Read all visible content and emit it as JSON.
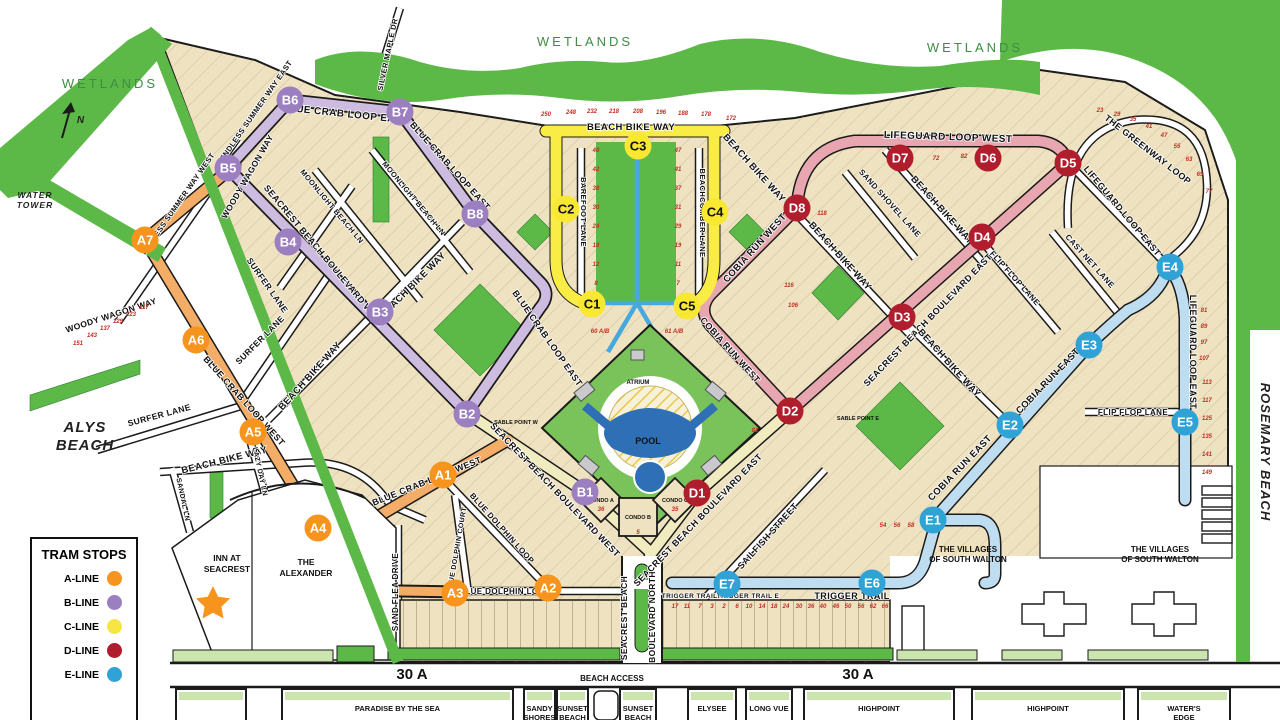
{
  "title": "Seacrest Beach community tram map",
  "colors": {
    "tan": "#efe2c0",
    "outline": "#1b1b1b",
    "green": "#5cb947",
    "light_green": "#cce5af",
    "a_stop": "#f7941d",
    "a_road": "#f4ad67",
    "b_stop": "#9c7fc0",
    "b_road": "#cdbce0",
    "c_stop": "#f9e832",
    "c_road": "#f8ec45",
    "d_stop": "#b01e2e",
    "d_road": "#e8a7b0",
    "e_stop": "#2fa3d6",
    "e_road": "#bfddf0",
    "pale_blvd": "#f1ecc0",
    "lot_number": "#c03026",
    "pool_blue": "#2f6fb5",
    "path_blue": "#46a8dc"
  },
  "legend": {
    "title": "TRAM STOPS",
    "items": [
      {
        "label": "A-LINE",
        "color": "#f7941d"
      },
      {
        "label": "B-LINE",
        "color": "#9c7fc0"
      },
      {
        "label": "C-LINE",
        "color": "#f5e642"
      },
      {
        "label": "D-LINE",
        "color": "#b01e2e"
      },
      {
        "label": "E-LINE",
        "color": "#2fa3d6"
      }
    ]
  },
  "compass": {
    "label": "N"
  },
  "stops": [
    {
      "id": "A1",
      "line": "A",
      "x": 443,
      "y": 475
    },
    {
      "id": "A2",
      "line": "A",
      "x": 548,
      "y": 588
    },
    {
      "id": "A3",
      "line": "A",
      "x": 455,
      "y": 593
    },
    {
      "id": "A4",
      "line": "A",
      "x": 318,
      "y": 528
    },
    {
      "id": "A5",
      "line": "A",
      "x": 253,
      "y": 432
    },
    {
      "id": "A6",
      "line": "A",
      "x": 196,
      "y": 340
    },
    {
      "id": "A7",
      "line": "A",
      "x": 145,
      "y": 240
    },
    {
      "id": "B1",
      "line": "B",
      "x": 585,
      "y": 492
    },
    {
      "id": "B2",
      "line": "B",
      "x": 467,
      "y": 414
    },
    {
      "id": "B3",
      "line": "B",
      "x": 380,
      "y": 312
    },
    {
      "id": "B4",
      "line": "B",
      "x": 288,
      "y": 242
    },
    {
      "id": "B5",
      "line": "B",
      "x": 228,
      "y": 168
    },
    {
      "id": "B6",
      "line": "B",
      "x": 290,
      "y": 100
    },
    {
      "id": "B7",
      "line": "B",
      "x": 400,
      "y": 112
    },
    {
      "id": "B8",
      "line": "B",
      "x": 475,
      "y": 214
    },
    {
      "id": "C1",
      "line": "C",
      "x": 592,
      "y": 304
    },
    {
      "id": "C2",
      "line": "C",
      "x": 566,
      "y": 209
    },
    {
      "id": "C3",
      "line": "C",
      "x": 638,
      "y": 146
    },
    {
      "id": "C4",
      "line": "C",
      "x": 715,
      "y": 212
    },
    {
      "id": "C5",
      "line": "C",
      "x": 687,
      "y": 306
    },
    {
      "id": "D1",
      "line": "D",
      "x": 697,
      "y": 493
    },
    {
      "id": "D2",
      "line": "D",
      "x": 790,
      "y": 411
    },
    {
      "id": "D3",
      "line": "D",
      "x": 902,
      "y": 317
    },
    {
      "id": "D4",
      "line": "D",
      "x": 982,
      "y": 237
    },
    {
      "id": "D5",
      "line": "D",
      "x": 1068,
      "y": 163
    },
    {
      "id": "D6",
      "line": "D",
      "x": 988,
      "y": 158
    },
    {
      "id": "D7",
      "line": "D",
      "x": 900,
      "y": 158
    },
    {
      "id": "D8",
      "line": "D",
      "x": 797,
      "y": 208
    },
    {
      "id": "E1",
      "line": "E",
      "x": 933,
      "y": 520
    },
    {
      "id": "E2",
      "line": "E",
      "x": 1010,
      "y": 425
    },
    {
      "id": "E3",
      "line": "E",
      "x": 1089,
      "y": 345
    },
    {
      "id": "E4",
      "line": "E",
      "x": 1170,
      "y": 267
    },
    {
      "id": "E5",
      "line": "E",
      "x": 1185,
      "y": 422
    },
    {
      "id": "E6",
      "line": "E",
      "x": 872,
      "y": 583
    },
    {
      "id": "E7",
      "line": "E",
      "x": 727,
      "y": 584
    }
  ],
  "streets": [
    {
      "t": "BLUE CRAB LOOP EAST",
      "x": 345,
      "y": 117,
      "r": 6,
      "s": 10
    },
    {
      "t": "BLUE CRAB LOOP EAST",
      "x": 448,
      "y": 168,
      "r": 48,
      "s": 9
    },
    {
      "t": "BLUE CRAB LOOP EAST",
      "x": 545,
      "y": 340,
      "r": 55,
      "s": 9
    },
    {
      "t": "BLUE CRAB LOOP WEST",
      "x": 242,
      "y": 403,
      "r": 48,
      "s": 9
    },
    {
      "t": "BLUE CRAB LOOP WEST",
      "x": 428,
      "y": 484,
      "r": -22,
      "s": 9
    },
    {
      "t": "SEACREST BEACH BOULEVARD WEST",
      "x": 322,
      "y": 258,
      "r": 50,
      "s": 9
    },
    {
      "t": "SEACREST BEACH BOULEVARD WEST",
      "x": 553,
      "y": 492,
      "r": 46,
      "s": 9
    },
    {
      "t": "SEACREST BEACH BOULEVARD EAST",
      "x": 930,
      "y": 322,
      "r": -46,
      "s": 9
    },
    {
      "t": "SEACREST BEACH BOULEVARD EAST",
      "x": 700,
      "y": 522,
      "r": -46,
      "s": 9
    },
    {
      "t": "BEACH BIKE WAY",
      "x": 225,
      "y": 463,
      "r": -14,
      "s": 9.5
    },
    {
      "t": "BEACH BIKE WAY",
      "x": 312,
      "y": 378,
      "r": -48,
      "s": 9.5
    },
    {
      "t": "BEACH BIKE WAY",
      "x": 415,
      "y": 287,
      "r": -45,
      "s": 9.5
    },
    {
      "t": "BEACH BIKE WAY",
      "x": 631,
      "y": 130,
      "r": 0,
      "s": 9.5
    },
    {
      "t": "BEACH BIKE WAY",
      "x": 752,
      "y": 170,
      "r": 48,
      "s": 9.5
    },
    {
      "t": "BEACH BIKE WAY",
      "x": 838,
      "y": 258,
      "r": 48,
      "s": 9.5
    },
    {
      "t": "BEACH BIKE WAY",
      "x": 940,
      "y": 212,
      "r": 48,
      "s": 9.5
    },
    {
      "t": "BEACH BIKE WAY",
      "x": 947,
      "y": 365,
      "r": 48,
      "s": 9.5
    },
    {
      "t": "LIFEGUARD LOOP WEST",
      "x": 948,
      "y": 140,
      "r": 2,
      "s": 10
    },
    {
      "t": "LIFEGUARD LOOP EAST",
      "x": 1120,
      "y": 213,
      "r": 50,
      "s": 9
    },
    {
      "t": "LIFEGUARD LOOP EAST",
      "x": 1190,
      "y": 352,
      "r": 90,
      "s": 9
    },
    {
      "t": "THE GREENWAY LOOP",
      "x": 1146,
      "y": 152,
      "r": 38,
      "s": 9
    },
    {
      "t": "COBIA RUN WEST",
      "x": 757,
      "y": 250,
      "r": -48,
      "s": 9.5
    },
    {
      "t": "COBIA RUN WEST",
      "x": 728,
      "y": 352,
      "r": 48,
      "s": 9
    },
    {
      "t": "COBIA RUN EAST",
      "x": 1050,
      "y": 383,
      "r": -46,
      "s": 9.5
    },
    {
      "t": "COBIA RUN EAST",
      "x": 962,
      "y": 470,
      "r": -46,
      "s": 9.5
    },
    {
      "t": "SAND SHOVEL LANE",
      "x": 888,
      "y": 205,
      "r": 48,
      "s": 8
    },
    {
      "t": "CAST NET LANE",
      "x": 1088,
      "y": 263,
      "r": 48,
      "s": 8
    },
    {
      "t": "FLIP FLOP LANE",
      "x": 1013,
      "y": 280,
      "r": 48,
      "s": 8
    },
    {
      "t": "FLIP FLOP LANE",
      "x": 1133,
      "y": 415,
      "r": 0,
      "s": 8
    },
    {
      "t": "SAILFISH STREET",
      "x": 770,
      "y": 538,
      "r": -48,
      "s": 9
    },
    {
      "t": "SAND FLEA DRIVE",
      "x": 398,
      "y": 592,
      "r": -90,
      "s": 8
    },
    {
      "t": "BLUE DOLPHIN COURT",
      "x": 459,
      "y": 550,
      "r": -80,
      "s": 7
    },
    {
      "t": "BLUE DOLPHIN LOOP",
      "x": 500,
      "y": 530,
      "r": 48,
      "s": 8
    },
    {
      "t": "BLUE DOLPHIN LOOP",
      "x": 505,
      "y": 594,
      "r": 0,
      "s": 8
    },
    {
      "t": "LAZY DAY LN",
      "x": 258,
      "y": 472,
      "r": 78,
      "s": 7
    },
    {
      "t": "SANDAL LN",
      "x": 181,
      "y": 500,
      "r": 78,
      "s": 7
    },
    {
      "t": "SURFER LANE",
      "x": 265,
      "y": 287,
      "r": 55,
      "s": 8.5
    },
    {
      "t": "SURFER LANE",
      "x": 160,
      "y": 418,
      "r": -15,
      "s": 8.5
    },
    {
      "t": "SURFER LANE",
      "x": 262,
      "y": 342,
      "r": -45,
      "s": 8.5
    },
    {
      "t": "WOODY WAGON WAY",
      "x": 250,
      "y": 178,
      "r": -60,
      "s": 8.5
    },
    {
      "t": "WOODY WAGON WAY",
      "x": 112,
      "y": 318,
      "r": -18,
      "s": 8.5
    },
    {
      "t": "MOONLIGHT BEACH LN",
      "x": 330,
      "y": 208,
      "r": 50,
      "s": 7.5
    },
    {
      "t": "MOONLIGHT BEACH LN",
      "x": 412,
      "y": 200,
      "r": 50,
      "s": 7.5
    },
    {
      "t": "ENDLESS SUMMER WAY EAST",
      "x": 258,
      "y": 112,
      "r": -55,
      "s": 7.5
    },
    {
      "t": "ENDLESS SUMMER WAY WEST",
      "x": 180,
      "y": 205,
      "r": -55,
      "s": 7.5
    },
    {
      "t": "SILVER MAPLE DR",
      "x": 390,
      "y": 55,
      "r": -78,
      "s": 7.5
    },
    {
      "t": "BAREFOOT LANE",
      "x": 581,
      "y": 212,
      "r": 90,
      "s": 7.5
    },
    {
      "t": "BEACHCOMBER LANE",
      "x": 700,
      "y": 213,
      "r": 90,
      "s": 7.5
    },
    {
      "t": "TRIGGER TRAIL W",
      "x": 694,
      "y": 598,
      "r": 0,
      "s": 6.5
    },
    {
      "t": "TRIGGER TRAIL E",
      "x": 748,
      "y": 598,
      "r": 0,
      "s": 6.5
    },
    {
      "t": "TRIGGER TRAIL",
      "x": 852,
      "y": 599,
      "r": 0,
      "s": 9
    },
    {
      "t": "SEACREST BEACH",
      "x": 627,
      "y": 618,
      "r": -90,
      "s": 8.5
    },
    {
      "t": "BOULEVARD NORTH",
      "x": 655,
      "y": 617,
      "r": -90,
      "s": 8.5
    }
  ],
  "places": [
    {
      "t": "WETLANDS",
      "x": 110,
      "y": 88,
      "cls": "wetl"
    },
    {
      "t": "WETLANDS",
      "x": 585,
      "y": 46,
      "cls": "wetl"
    },
    {
      "t": "WETLANDS",
      "x": 975,
      "y": 52,
      "cls": "wetl"
    },
    {
      "lines": [
        "ALYS",
        "BEACH"
      ],
      "x": 85,
      "y": 432,
      "s": 15,
      "cls": "italpl",
      "lh": 18
    },
    {
      "t": "ROSEMARY BEACH",
      "x": 1261,
      "y": 452,
      "s": 13,
      "cls": "italpl",
      "r": 90
    },
    {
      "lines": [
        "WATER",
        "TOWER"
      ],
      "x": 35,
      "y": 198,
      "s": 8.5,
      "cls": "italpl",
      "lh": 10
    },
    {
      "lines": [
        "INN AT",
        "SEACREST"
      ],
      "x": 227,
      "y": 561,
      "s": 8.5,
      "cls": "place",
      "lh": 11
    },
    {
      "lines": [
        "THE",
        "ALEXANDER"
      ],
      "x": 306,
      "y": 565,
      "s": 8.5,
      "cls": "place",
      "lh": 11
    },
    {
      "lines": [
        "THE VILLAGES",
        "OF SOUTH WALTON"
      ],
      "x": 968,
      "y": 552,
      "s": 8,
      "cls": "place",
      "lh": 10
    },
    {
      "lines": [
        "THE VILLAGES",
        "OF SOUTH WALTON"
      ],
      "x": 1160,
      "y": 552,
      "s": 8,
      "cls": "place",
      "lh": 10
    },
    {
      "t": "ATRIUM",
      "x": 638,
      "y": 384,
      "s": 6,
      "cls": "place"
    },
    {
      "t": "POOL",
      "x": 648,
      "y": 444,
      "s": 9,
      "cls": "place",
      "fill": "#ffffff"
    },
    {
      "t": "CONDO A",
      "x": 601,
      "y": 502,
      "s": 5.5,
      "cls": "place"
    },
    {
      "t": "CONDO B",
      "x": 638,
      "y": 519,
      "s": 5.5,
      "cls": "place"
    },
    {
      "t": "CONDO C",
      "x": 675,
      "y": 502,
      "s": 5.5,
      "cls": "place"
    },
    {
      "t": "SABLE POINT W",
      "x": 516,
      "y": 424,
      "s": 5.5,
      "cls": "place"
    },
    {
      "t": "SABLE POINT E",
      "x": 858,
      "y": 420,
      "s": 5.5,
      "cls": "place"
    },
    {
      "t": "30 A",
      "x": 412,
      "y": 679,
      "s": 15,
      "cls": "place"
    },
    {
      "t": "30 A",
      "x": 858,
      "y": 679,
      "s": 15,
      "cls": "place"
    },
    {
      "t": "BEACH ACCESS",
      "x": 612,
      "y": 681,
      "s": 8,
      "cls": "place"
    },
    {
      "t": "N",
      "x": 81,
      "y": 123,
      "s": 10,
      "cls": "italpl"
    }
  ],
  "communities": [
    {
      "label": "",
      "x": 176,
      "w": 70
    },
    {
      "label": "PARADISE BY THE SEA",
      "x": 282,
      "w": 231
    },
    {
      "label": "SANDY|SHORES",
      "x": 524,
      "w": 31
    },
    {
      "label": "SUNSET|BEACH",
      "x": 557,
      "w": 31
    },
    {
      "label": "SUNSET|BEACH",
      "x": 620,
      "w": 36
    },
    {
      "label": "ELYSEE",
      "x": 688,
      "w": 48
    },
    {
      "label": "LONG VUE",
      "x": 746,
      "w": 46
    },
    {
      "label": "HIGHPOINT",
      "x": 804,
      "w": 150
    },
    {
      "label": "HIGHPOINT",
      "x": 972,
      "w": 152
    },
    {
      "label": "WATER'S|EDGE",
      "x": 1138,
      "w": 92
    }
  ],
  "lot_numbers": [
    {
      "t": "250",
      "x": 546,
      "y": 116
    },
    {
      "t": "248",
      "x": 571,
      "y": 114
    },
    {
      "t": "232",
      "x": 592,
      "y": 113
    },
    {
      "t": "218",
      "x": 614,
      "y": 113
    },
    {
      "t": "208",
      "x": 638,
      "y": 113
    },
    {
      "t": "196",
      "x": 661,
      "y": 114
    },
    {
      "t": "188",
      "x": 683,
      "y": 115
    },
    {
      "t": "178",
      "x": 706,
      "y": 116
    },
    {
      "t": "172",
      "x": 731,
      "y": 120
    },
    {
      "t": "48",
      "x": 596,
      "y": 152
    },
    {
      "t": "42",
      "x": 596,
      "y": 171
    },
    {
      "t": "38",
      "x": 596,
      "y": 190
    },
    {
      "t": "30",
      "x": 596,
      "y": 209
    },
    {
      "t": "24",
      "x": 596,
      "y": 228
    },
    {
      "t": "18",
      "x": 596,
      "y": 247
    },
    {
      "t": "12",
      "x": 596,
      "y": 266
    },
    {
      "t": "8",
      "x": 596,
      "y": 285
    },
    {
      "t": "47",
      "x": 678,
      "y": 152
    },
    {
      "t": "41",
      "x": 678,
      "y": 171
    },
    {
      "t": "37",
      "x": 678,
      "y": 190
    },
    {
      "t": "31",
      "x": 678,
      "y": 209
    },
    {
      "t": "29",
      "x": 678,
      "y": 228
    },
    {
      "t": "19",
      "x": 678,
      "y": 247
    },
    {
      "t": "11",
      "x": 678,
      "y": 266
    },
    {
      "t": "7",
      "x": 678,
      "y": 285
    },
    {
      "t": "60 A/B",
      "x": 600,
      "y": 333
    },
    {
      "t": "61 A/B",
      "x": 674,
      "y": 333
    },
    {
      "t": "54",
      "x": 883,
      "y": 527
    },
    {
      "t": "56",
      "x": 897,
      "y": 527
    },
    {
      "t": "58",
      "x": 911,
      "y": 527
    },
    {
      "t": "17",
      "x": 675,
      "y": 608
    },
    {
      "t": "11",
      "x": 687,
      "y": 608
    },
    {
      "t": "7",
      "x": 700,
      "y": 608
    },
    {
      "t": "3",
      "x": 712,
      "y": 608
    },
    {
      "t": "2",
      "x": 724,
      "y": 608
    },
    {
      "t": "6",
      "x": 737,
      "y": 608
    },
    {
      "t": "10",
      "x": 749,
      "y": 608
    },
    {
      "t": "14",
      "x": 762,
      "y": 608
    },
    {
      "t": "18",
      "x": 774,
      "y": 608
    },
    {
      "t": "24",
      "x": 786,
      "y": 608
    },
    {
      "t": "30",
      "x": 799,
      "y": 608
    },
    {
      "t": "36",
      "x": 811,
      "y": 608
    },
    {
      "t": "40",
      "x": 823,
      "y": 608
    },
    {
      "t": "46",
      "x": 836,
      "y": 608
    },
    {
      "t": "50",
      "x": 848,
      "y": 608
    },
    {
      "t": "56",
      "x": 861,
      "y": 608
    },
    {
      "t": "62",
      "x": 873,
      "y": 608
    },
    {
      "t": "66",
      "x": 885,
      "y": 608
    },
    {
      "t": "81",
      "x": 1204,
      "y": 312
    },
    {
      "t": "89",
      "x": 1204,
      "y": 328
    },
    {
      "t": "97",
      "x": 1204,
      "y": 344
    },
    {
      "t": "107",
      "x": 1204,
      "y": 360
    },
    {
      "t": "113",
      "x": 1207,
      "y": 384
    },
    {
      "t": "117",
      "x": 1207,
      "y": 402
    },
    {
      "t": "125",
      "x": 1207,
      "y": 420
    },
    {
      "t": "135",
      "x": 1207,
      "y": 438
    },
    {
      "t": "141",
      "x": 1207,
      "y": 456
    },
    {
      "t": "149",
      "x": 1207,
      "y": 474
    },
    {
      "t": "23",
      "x": 1100,
      "y": 112
    },
    {
      "t": "29",
      "x": 1117,
      "y": 116
    },
    {
      "t": "35",
      "x": 1133,
      "y": 121
    },
    {
      "t": "41",
      "x": 1149,
      "y": 128
    },
    {
      "t": "47",
      "x": 1164,
      "y": 137
    },
    {
      "t": "55",
      "x": 1177,
      "y": 148
    },
    {
      "t": "63",
      "x": 1189,
      "y": 161
    },
    {
      "t": "69",
      "x": 1200,
      "y": 176
    },
    {
      "t": "77",
      "x": 1209,
      "y": 193
    },
    {
      "t": "151",
      "x": 78,
      "y": 345
    },
    {
      "t": "143",
      "x": 92,
      "y": 337
    },
    {
      "t": "137",
      "x": 105,
      "y": 330
    },
    {
      "t": "129",
      "x": 118,
      "y": 323
    },
    {
      "t": "123",
      "x": 131,
      "y": 316
    },
    {
      "t": "117",
      "x": 144,
      "y": 309
    },
    {
      "t": "72",
      "x": 936,
      "y": 160
    },
    {
      "t": "82",
      "x": 964,
      "y": 158
    },
    {
      "t": "118",
      "x": 822,
      "y": 215
    },
    {
      "t": "116",
      "x": 789,
      "y": 287
    },
    {
      "t": "106",
      "x": 793,
      "y": 307
    },
    {
      "t": "81",
      "x": 755,
      "y": 432
    },
    {
      "t": "36",
      "x": 601,
      "y": 511
    },
    {
      "t": "35",
      "x": 675,
      "y": 511
    },
    {
      "t": "5",
      "x": 638,
      "y": 534
    }
  ]
}
